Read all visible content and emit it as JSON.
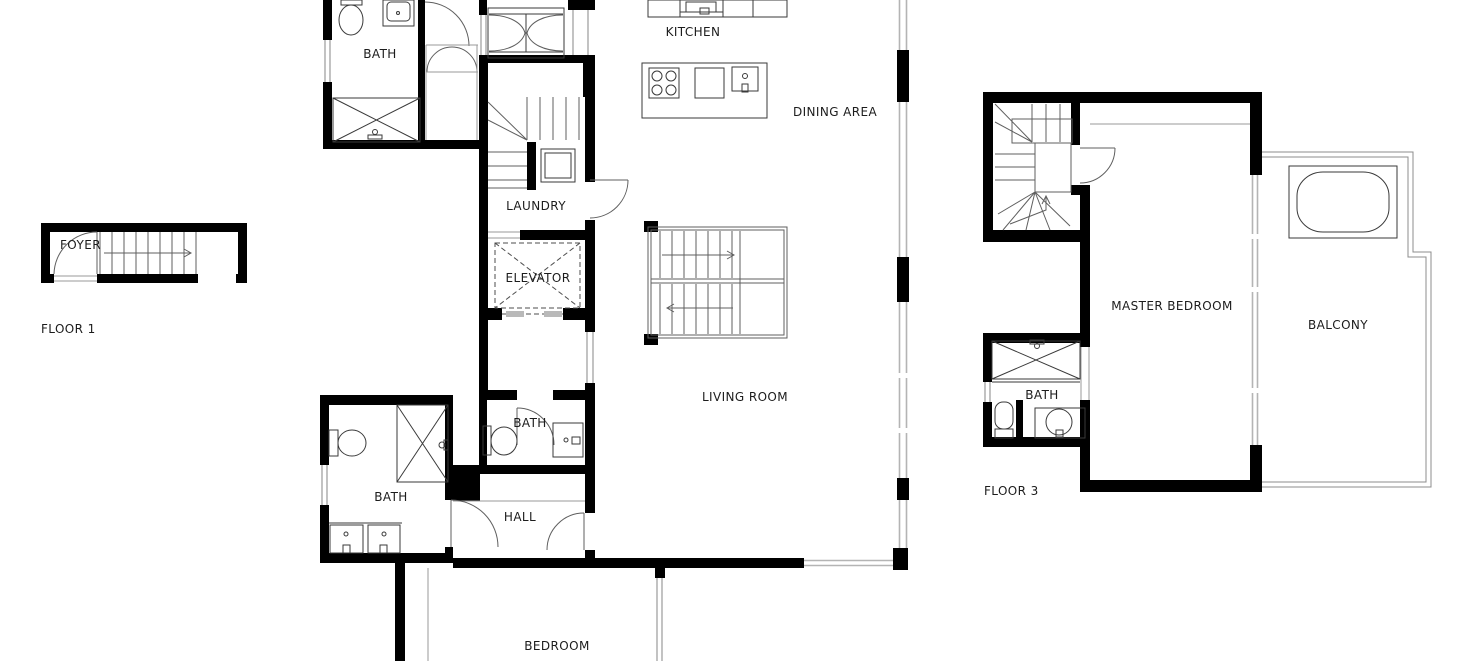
{
  "document": {
    "kind": "architectural-floor-plan",
    "floor_count_visible": 3
  },
  "floors": {
    "floor1": {
      "title": "FLOOR 1",
      "rooms": {
        "foyer": "FOYER"
      }
    },
    "floor2": {
      "rooms": {
        "bath_upper": "BATH",
        "kitchen": "KITCHEN",
        "dining_area": "DINING AREA",
        "laundry": "LAUNDRY",
        "elevator": "ELEVATOR",
        "living_room": "LIVING ROOM",
        "bath_mid": "BATH",
        "bath_lower": "BATH",
        "hall": "HALL",
        "bedroom": "BEDROOM"
      }
    },
    "floor3": {
      "title": "FLOOR 3",
      "rooms": {
        "master_bedroom": "MASTER BEDROOM",
        "balcony": "BALCONY",
        "bath": "BATH"
      }
    }
  },
  "colors": {
    "background": "#ffffff",
    "wall": "#000000",
    "fixture_line": "#3a3a3a",
    "stair_line": "#5f5f5f",
    "window_line": "#b4b4b4",
    "balcony_line": "#8c8c8c",
    "elevator_door_panel": "#b9b9b9",
    "label_text": "#1c1c1c"
  }
}
